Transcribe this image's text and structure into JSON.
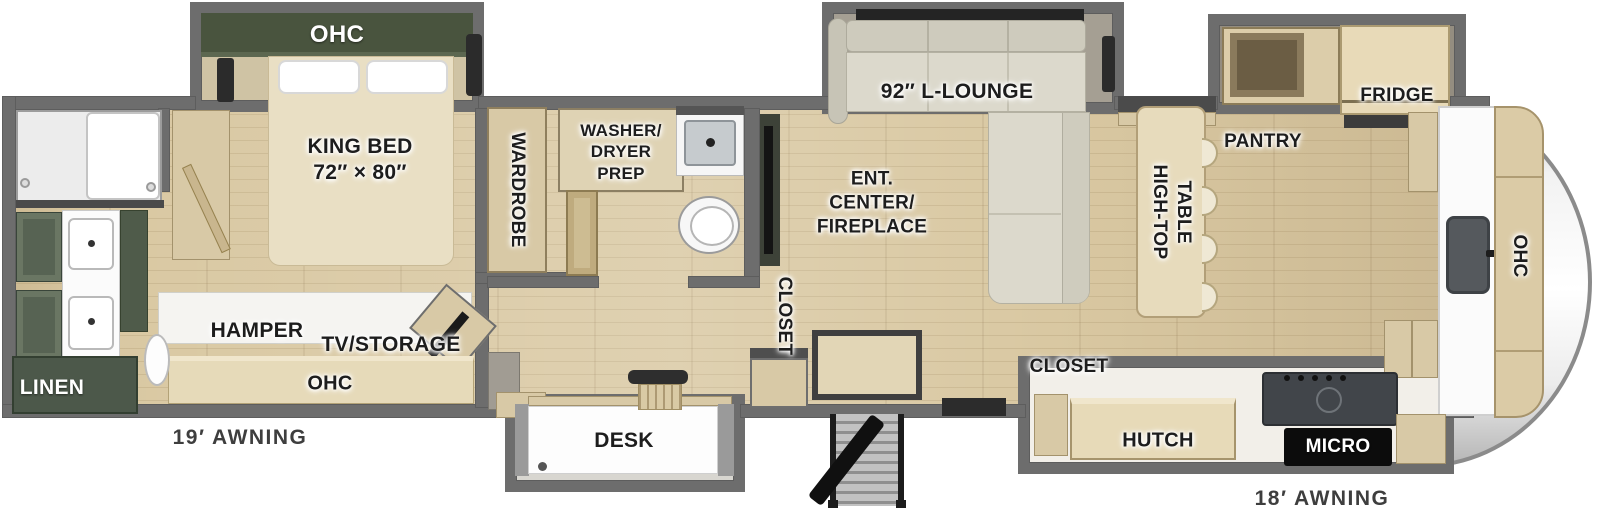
{
  "title": "Fifth Wheel RV Floor Plan",
  "colors": {
    "wall_gray": "#6d6d6d",
    "cabinet_green": "#49543e",
    "wood": "#d8c9a6",
    "floor_wood": "#d9c8a2",
    "sofa_gray": "#dcd9cc",
    "appliance_dark": "#2c2c2c"
  },
  "labels": {
    "bedroom_ohc": "OHC",
    "king_bed": "KING BED\n72″ × 80″",
    "wardrobe": "WARDROBE",
    "washer_dryer": "WASHER/\nDRYER\nPREP",
    "hamper": "HAMPER",
    "tv_storage": "TV/STORAGE",
    "bedroom_ohc_lower": "OHC",
    "linen": "LINEN",
    "awning_left": "19′ AWNING",
    "desk": "DESK",
    "ent_center": "ENT.\nCENTER/\nFIREPLACE",
    "closet_mid": "CLOSET",
    "l_lounge": "92″ L-LOUNGE",
    "high_top": "HIGH-TOP\nTABLE",
    "pantry": "PANTRY",
    "fridge": "FRIDGE",
    "closet_kitchen": "CLOSET",
    "hutch": "HUTCH",
    "micro": "MICRO",
    "galley_ohc": "OHC",
    "awning_right": "18′ AWNING"
  }
}
